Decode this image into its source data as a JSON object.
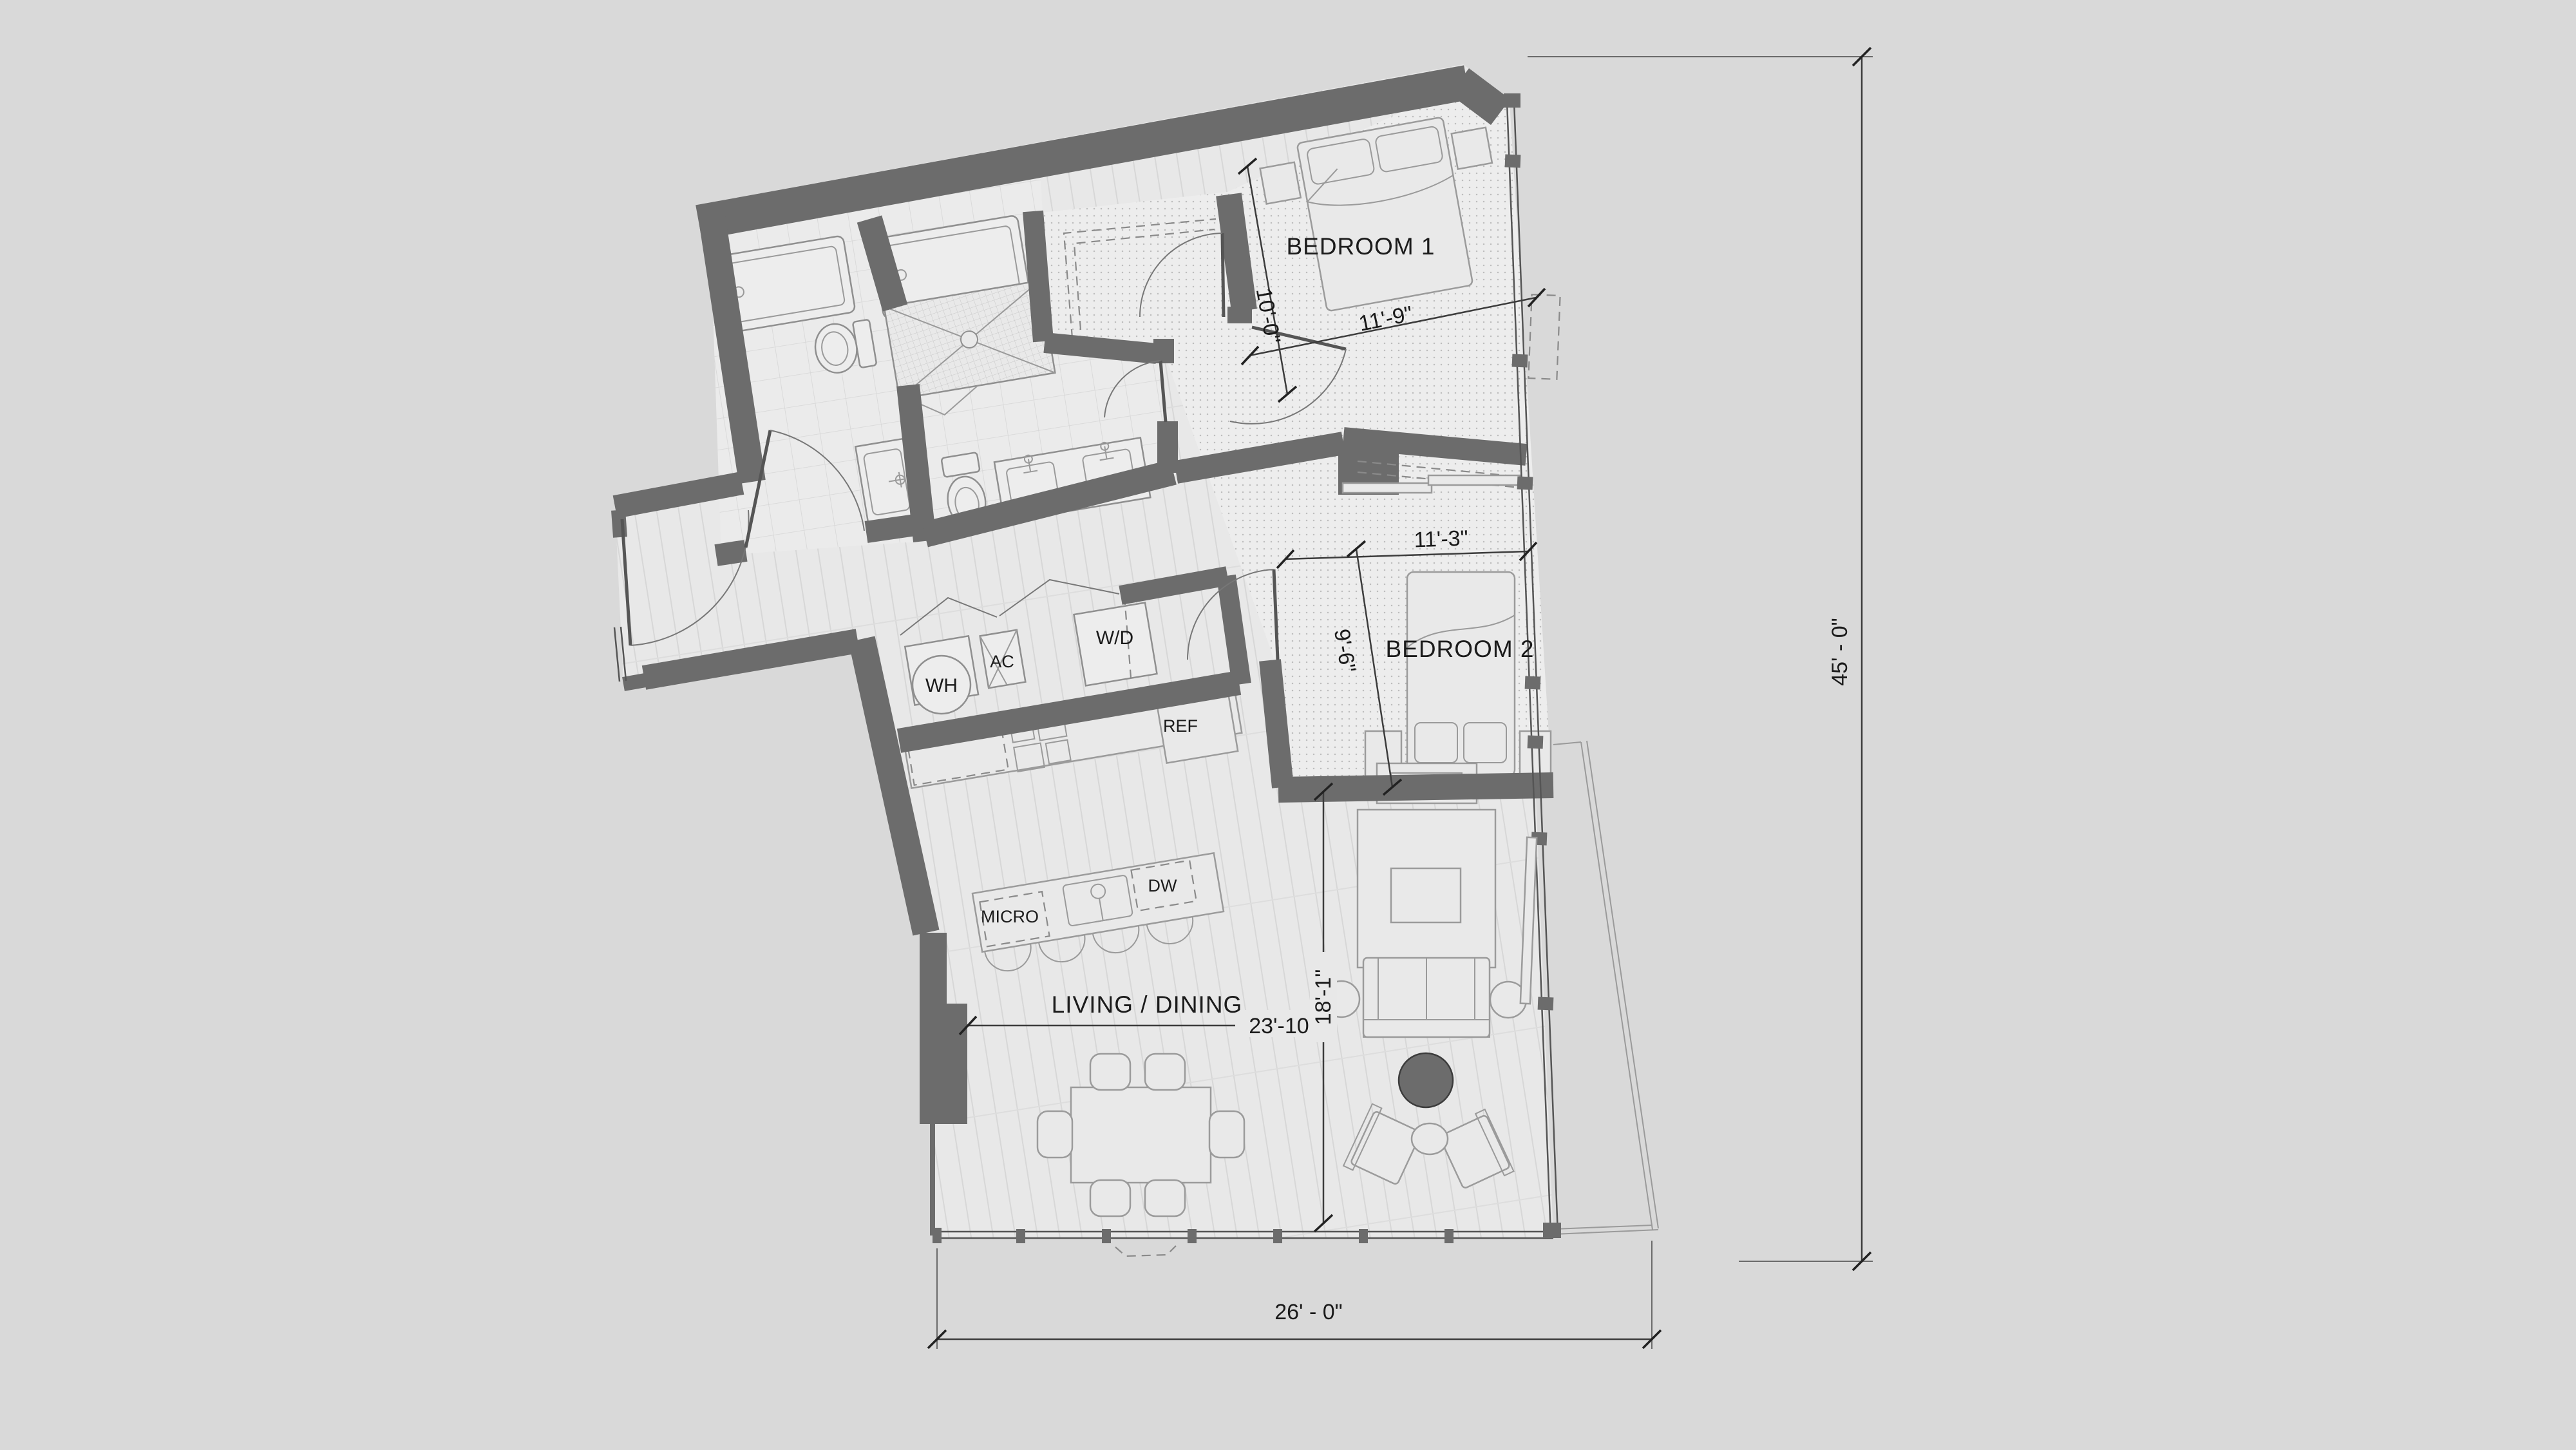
{
  "plan": {
    "title": "2 bedroom / 2 bath unit floor plan",
    "rooms": {
      "bedroom1": "BEDROOM 1",
      "bedroom2": "BEDROOM 2",
      "living": "LIVING / DINING"
    },
    "appliances": {
      "water_heater": "WH",
      "air_conditioner": "AC",
      "washer_dryer": "W/D",
      "refrigerator": "REF",
      "microwave": "MICRO",
      "dishwasher": "DW"
    },
    "dimensions": {
      "bedroom1_depth": "10'-0\"",
      "bedroom1_width": "11'-9\"",
      "bedroom2_width": "11'-3\"",
      "bedroom2_depth": "9'-6\"",
      "living_width": "23'-10\"",
      "living_depth": "18'-1\"",
      "overall_width": "26' - 0\"",
      "overall_height": "45' - 0\""
    },
    "colors": {
      "background": "#d9d9d9",
      "wall": "#6c6c6c",
      "floor": "#e8e8e8",
      "dark_accent": "#6c6c6c"
    }
  }
}
